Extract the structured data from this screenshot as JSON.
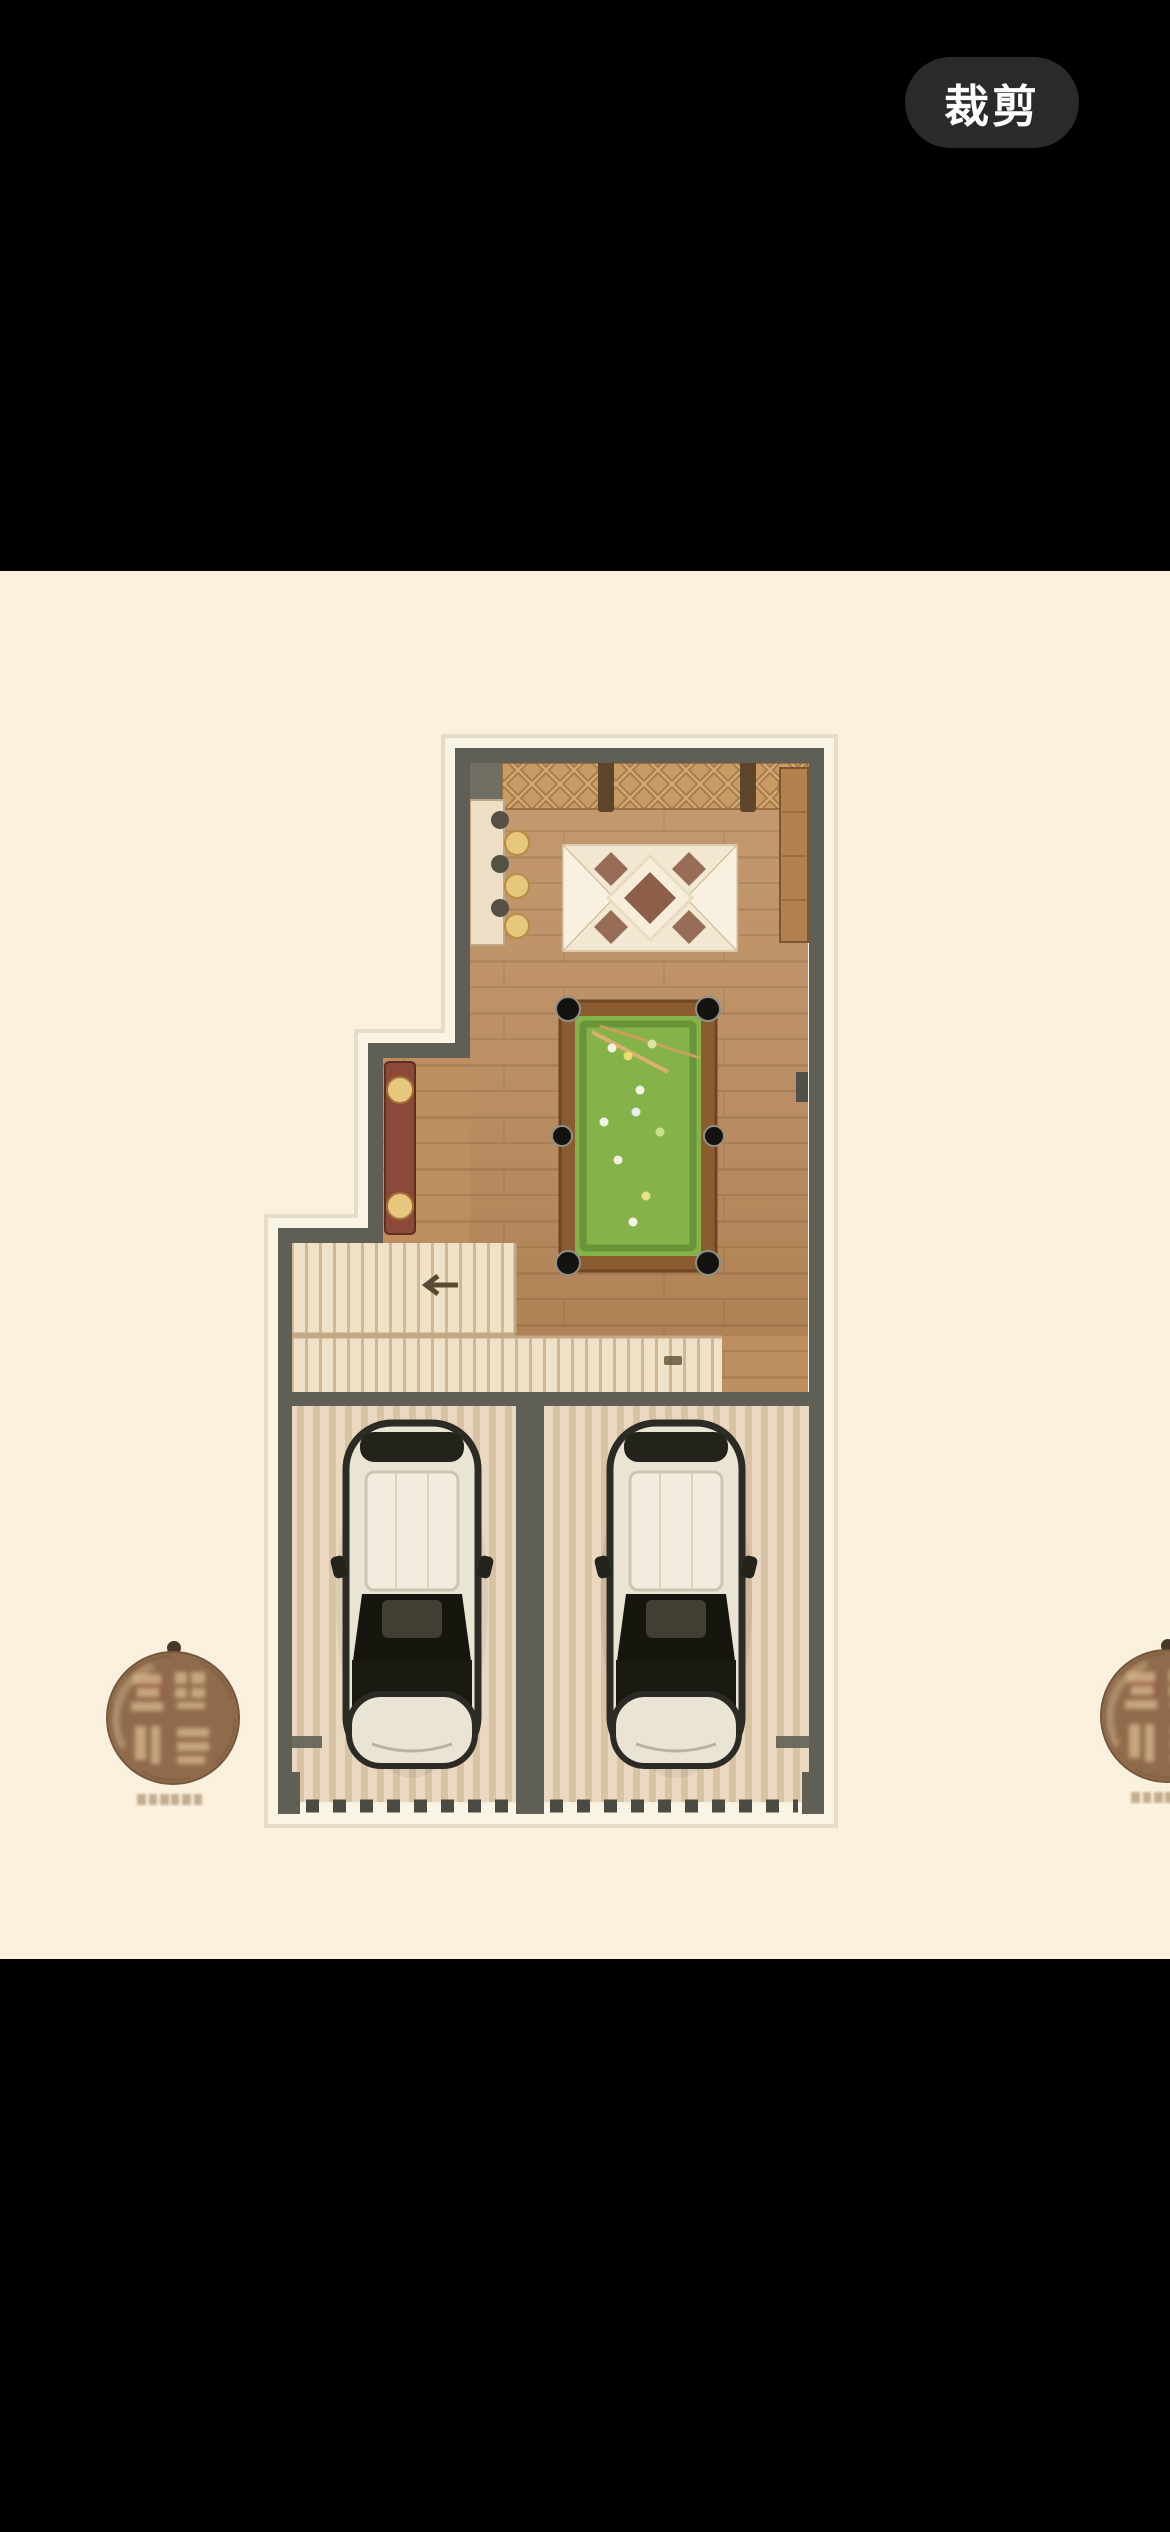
{
  "screen": {
    "background": "#000000"
  },
  "toolbar": {
    "crop_label": "裁剪",
    "crop_button_bg": "#2a2a2c",
    "crop_button_text_color": "#ffffff"
  },
  "photo": {
    "background": "#fcf1dc",
    "description": "Floor plan drawing: basement leisure level with billiards room (pool table, dining rug, lattice screen, bar counter), staircase, and a double garage with two cars; round brown developer seals on left and right edges.",
    "palette": {
      "photo_bg": "#fcf1dc",
      "wall": "#605f55",
      "wood_floor": "#bd8e5f",
      "plank_line": "#a3784c",
      "stair_floor": "#f0e2c8",
      "stair_line": "#d0b896",
      "garage_floor": "#ead9c0",
      "garage_stripe": "#d9c3a5",
      "pool_green": "#85b34a",
      "pool_green_dark": "#69953a",
      "pool_rim": "#8a5c30",
      "rug_cream": "#f2e8d2",
      "rug_brown": "#8d5f49",
      "lattice_tan": "#c89a64",
      "lattice_dark": "#8f6537",
      "cabinet_red": "#8d4937",
      "gold": "#e7c77d",
      "car_body": "#e9e4d4",
      "seal_brown": "#8f6b4c",
      "crop_bg": "#2a2a2c",
      "crop_fg": "#ffffff"
    },
    "floorplan": {
      "rooms": [
        {
          "id": "billiards-room",
          "items": [
            "lattice-screen",
            "bar-counter-with-stools",
            "dining-rug-with-table",
            "side-cabinet",
            "billiards-table",
            "display-cabinet"
          ]
        },
        {
          "id": "staircase",
          "items": [
            "stair-treads",
            "direction-arrow",
            "landing"
          ]
        },
        {
          "id": "garage-left",
          "items": [
            "car"
          ]
        },
        {
          "id": "garage-right",
          "items": [
            "car"
          ]
        }
      ],
      "watermarks": [
        {
          "id": "seal-left",
          "shape": "round brown seal with character marks and caption"
        },
        {
          "id": "seal-right",
          "shape": "round brown seal, clipped by right screen edge"
        }
      ]
    }
  }
}
